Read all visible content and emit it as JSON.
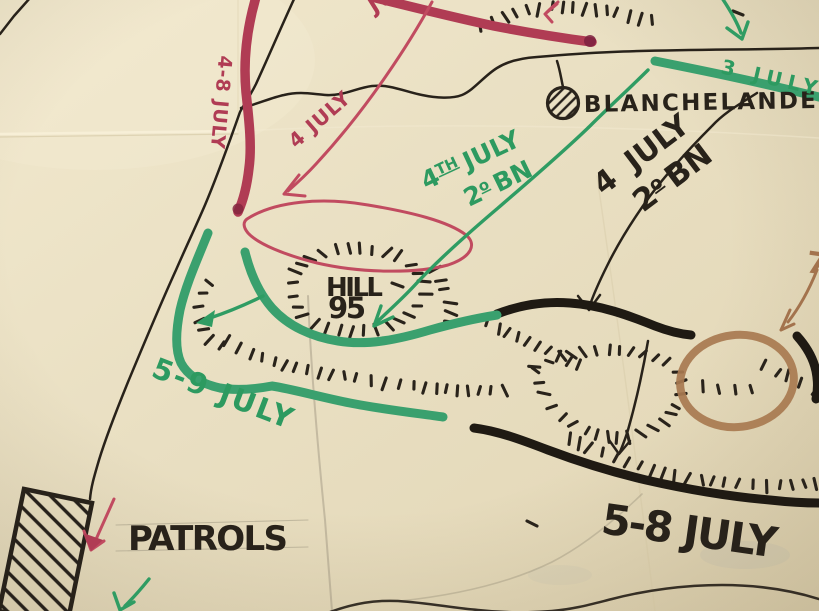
{
  "colors": {
    "paper": "#e9dfc2",
    "ink_black": "#28221a",
    "ink_red": "#b03c54",
    "ink_green": "#3aa06e",
    "ink_brown": "#a3734d"
  },
  "labels": {
    "place": "BLANCHELANDE",
    "hill_name": "HILL",
    "hill_height": "95",
    "red_west_route": "4-8 JULY",
    "red_center_route": "4 JULY",
    "red_top_partial": "JULY",
    "green_ne_route": "3 JULY",
    "green_advance_day": "4",
    "green_advance_day_suffix": "TH",
    "green_advance_month": "JULY",
    "green_advance_unit_num": "2",
    "green_advance_unit_suffix": "o",
    "green_advance_unit": "BN",
    "black_advance_date": "4 JULY",
    "black_advance_unit_num": "2",
    "black_advance_unit_suffix": "o",
    "black_advance_unit": "BN",
    "green_position": "5-9 JULY",
    "black_position": "5-8 JULY",
    "patrols": "PATROLS",
    "brown_partial": "7"
  }
}
